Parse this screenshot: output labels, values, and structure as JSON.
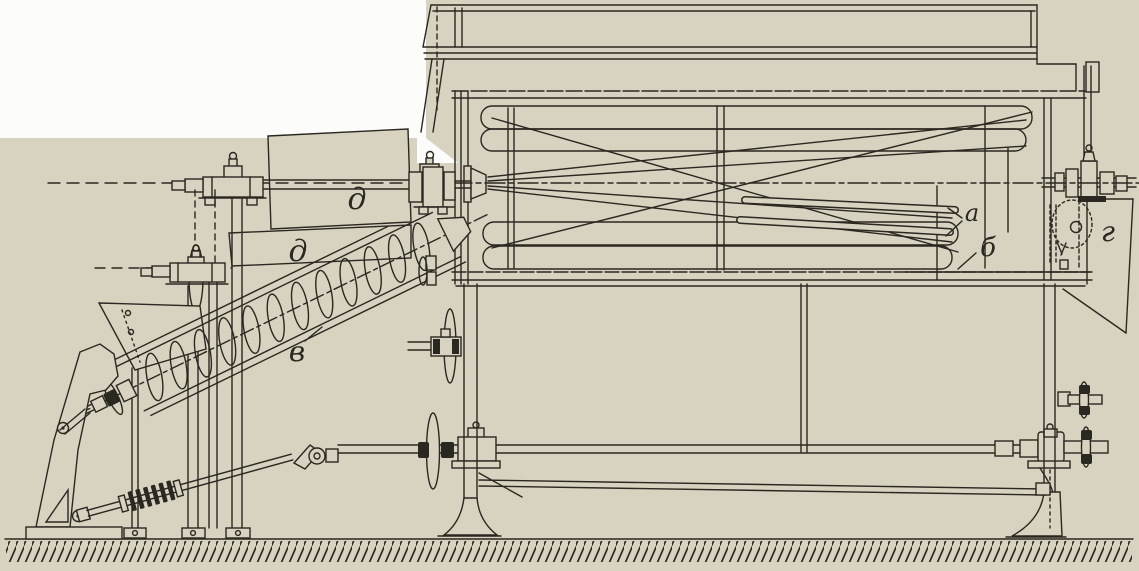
{
  "figure": {
    "kind": "scanned technical line drawing on aged book paper",
    "subject": "Side elevation of a grain-cleaning machine: cylindrical drum housing with internal reel tubes, inclined screw feed conveyor, belt pulleys and a long lower drive shaft on pedestal bearings, standing on hatched ground"
  },
  "palette": {
    "paper": "#d7d3c0",
    "ink": "#2b2721",
    "white": "#fcfcfa"
  },
  "labels": {
    "a": "а",
    "b": "б",
    "v": "в",
    "g": "г",
    "d_upper": "д",
    "d_lower": "д"
  }
}
